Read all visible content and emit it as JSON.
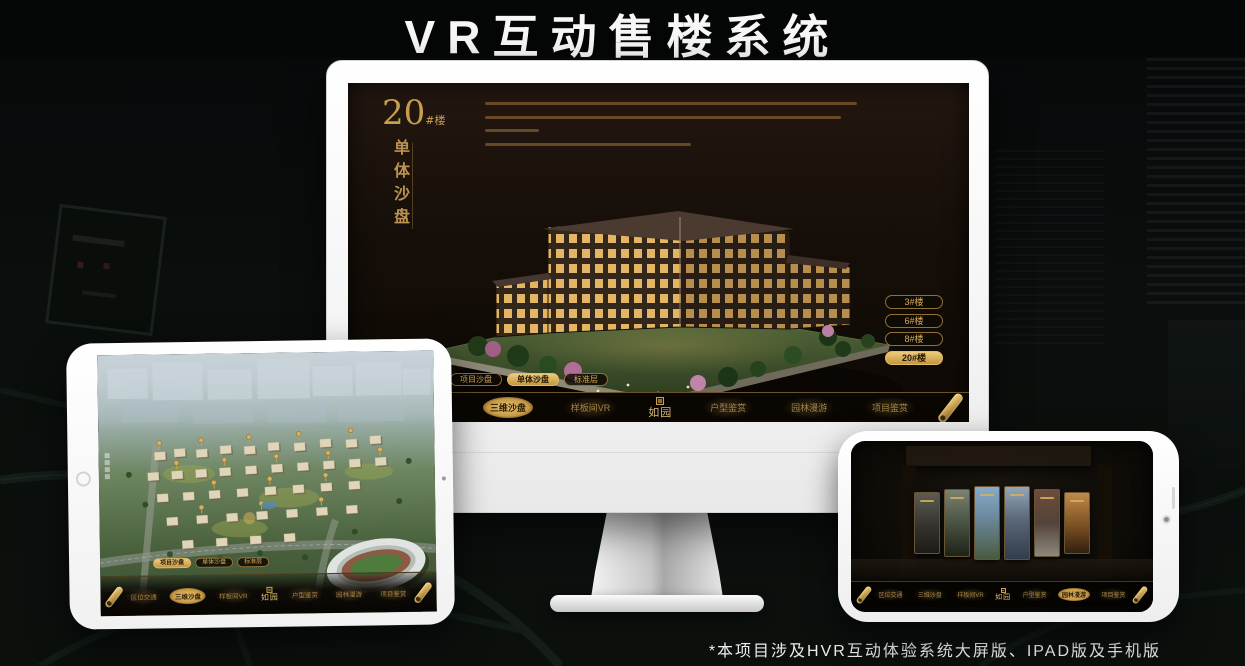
{
  "page": {
    "title": "VR互动售楼系统",
    "footnote": "*本项目涉及HVR互动体验系统大屏版、IPAD版及手机版"
  },
  "colors": {
    "accent_gold": "#D2A855",
    "active_gold": "#E3BC66",
    "screen_brown": "#1B130B",
    "nav_black": "#0B0803",
    "title_white": "#F5F5F5"
  },
  "icons": {
    "nav_scroll": "gold-scroll-roll",
    "logo_seal": "brand-seal-stamp",
    "building_marker": "gold-building-marker",
    "home_button": "tablet-home-button",
    "camera": "camera-dot"
  },
  "nav": {
    "logo": "如园",
    "items": [
      {
        "label": "区位交通"
      },
      {
        "label": "三维沙盘"
      },
      {
        "label": "样板间VR"
      },
      {
        "label": "户型鉴赏"
      },
      {
        "label": "园林漫游"
      },
      {
        "label": "项目鉴赏"
      }
    ]
  },
  "sub_tabs": [
    {
      "label": "项目沙盘"
    },
    {
      "label": "单体沙盘"
    },
    {
      "label": "标准层"
    }
  ],
  "desktop": {
    "headline_number": "20",
    "headline_suffix": "#楼",
    "headline_vertical": "单体沙盘",
    "active_nav": "三维沙盘",
    "active_sub_tab": "单体沙盘",
    "floor_buttons": [
      {
        "label": "3#楼",
        "active": false
      },
      {
        "label": "6#楼",
        "active": false
      },
      {
        "label": "8#楼",
        "active": false
      },
      {
        "label": "20#楼",
        "active": true
      }
    ]
  },
  "tablet": {
    "active_sub_tab": "项目沙盘",
    "active_nav": "三维沙盘"
  },
  "phone": {
    "active_nav": "园林漫游",
    "gallery_card_count": 6
  }
}
